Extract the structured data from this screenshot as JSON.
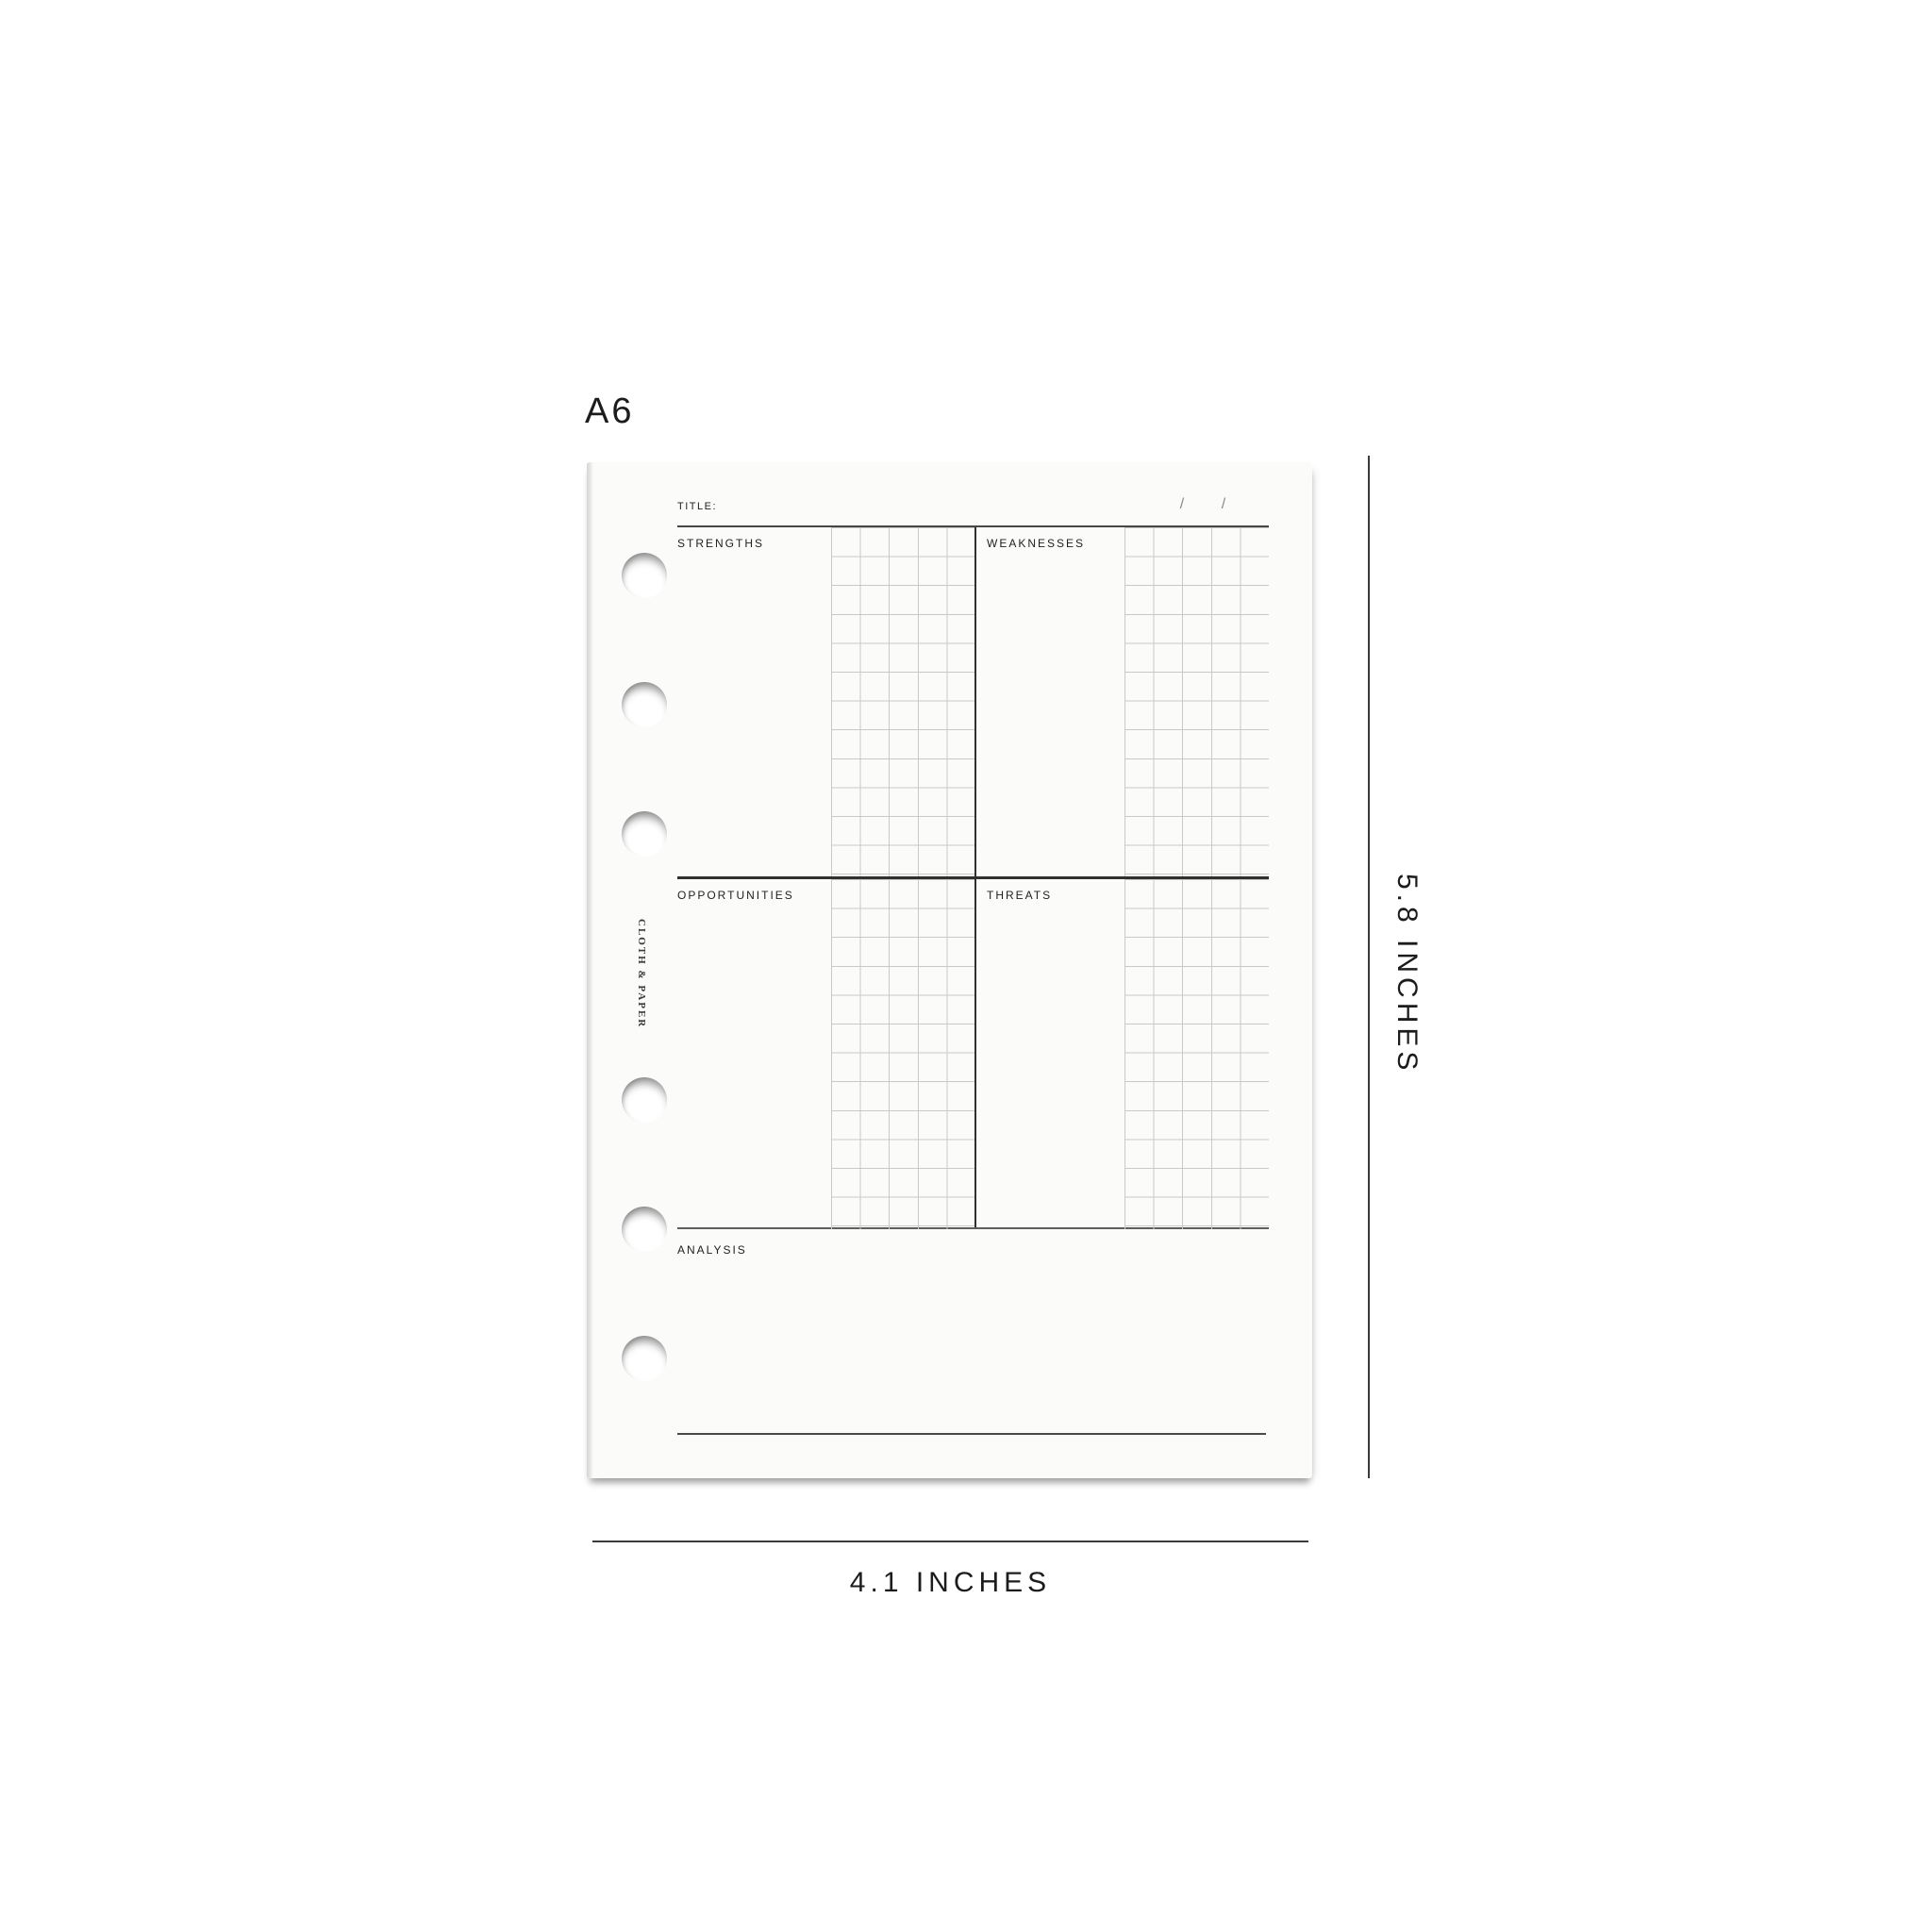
{
  "size_label": "A6",
  "page": {
    "title_label": "TITLE:",
    "date_slash_1": "/",
    "date_slash_2": "/",
    "brand_vertical": "CLOTH & PAPER",
    "quadrants": [
      {
        "label": "STRENGTHS"
      },
      {
        "label": "WEAKNESSES"
      },
      {
        "label": "OPPORTUNITIES"
      },
      {
        "label": "THREATS"
      }
    ],
    "analysis_label": "ANALYSIS"
  },
  "dimensions": {
    "height_label": "5.8 INCHES",
    "width_label": "4.1 INCHES"
  },
  "colors": {
    "page_background": "#fbfbf9",
    "table_line": "#303030",
    "secondary_line": "#5e5e5e",
    "grid_line": "#c9c9c9",
    "text": "#1f1f1f",
    "slash": "#8a8a8a",
    "dimension_line": "#3b3b3b"
  }
}
